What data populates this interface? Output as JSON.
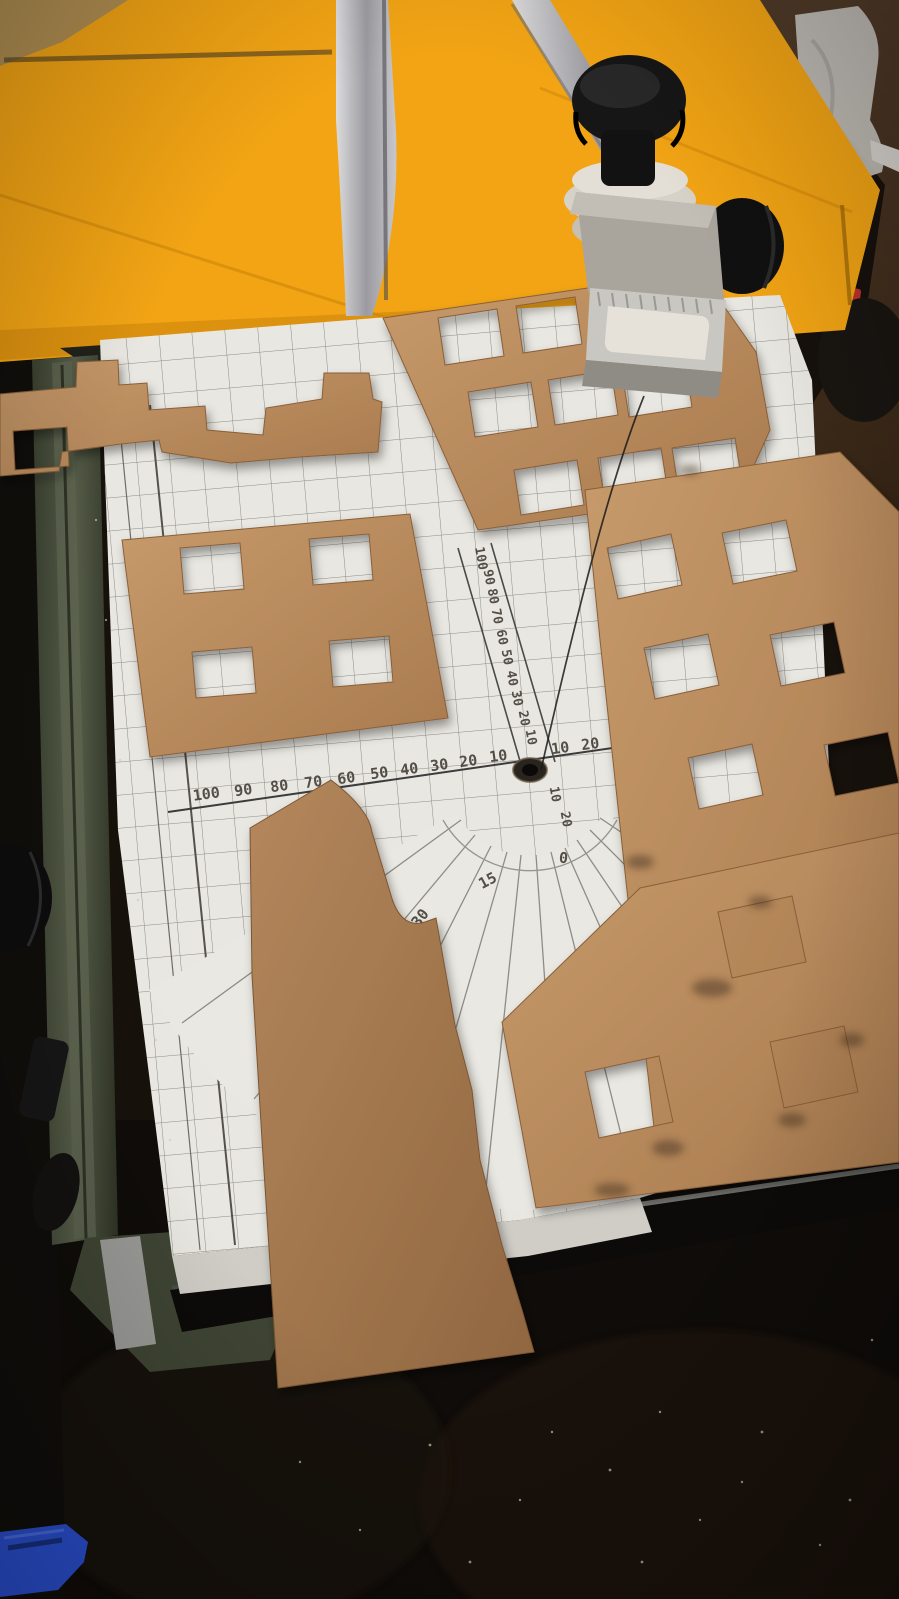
{
  "scene": {
    "kind": "photograph",
    "subject": "hot-wire foam cutter table with laser-cut cardboard building facades on a printed grid cutting mat"
  },
  "mat": {
    "h_scale_left": [
      "100",
      "90",
      "80",
      "70",
      "60",
      "50",
      "40",
      "30",
      "20",
      "10"
    ],
    "h_scale_right": [
      "10",
      "20"
    ],
    "v_scale": [
      "100",
      "90",
      "80",
      "70",
      "60",
      "50",
      "40",
      "30",
      "20",
      "10"
    ],
    "v_scale_below": [
      "10",
      "20"
    ],
    "protractor": [
      "30",
      "15",
      "0",
      "15"
    ]
  },
  "colors": {
    "foam_yellow": "#f2a414",
    "foam_yellow_dark": "#e08f0c",
    "cardboard": "#b9895a",
    "cardboard_dark": "#93683f",
    "mat_white": "#e9e7e1",
    "grid_line": "#8b8b85",
    "machine_green": "#4c5240",
    "table_wood": "#4a3524",
    "metal_silver": "#b9b9bd",
    "knob_black": "#161616",
    "blue_tool": "#2a4fd0",
    "wire": "#1a1a1a"
  }
}
